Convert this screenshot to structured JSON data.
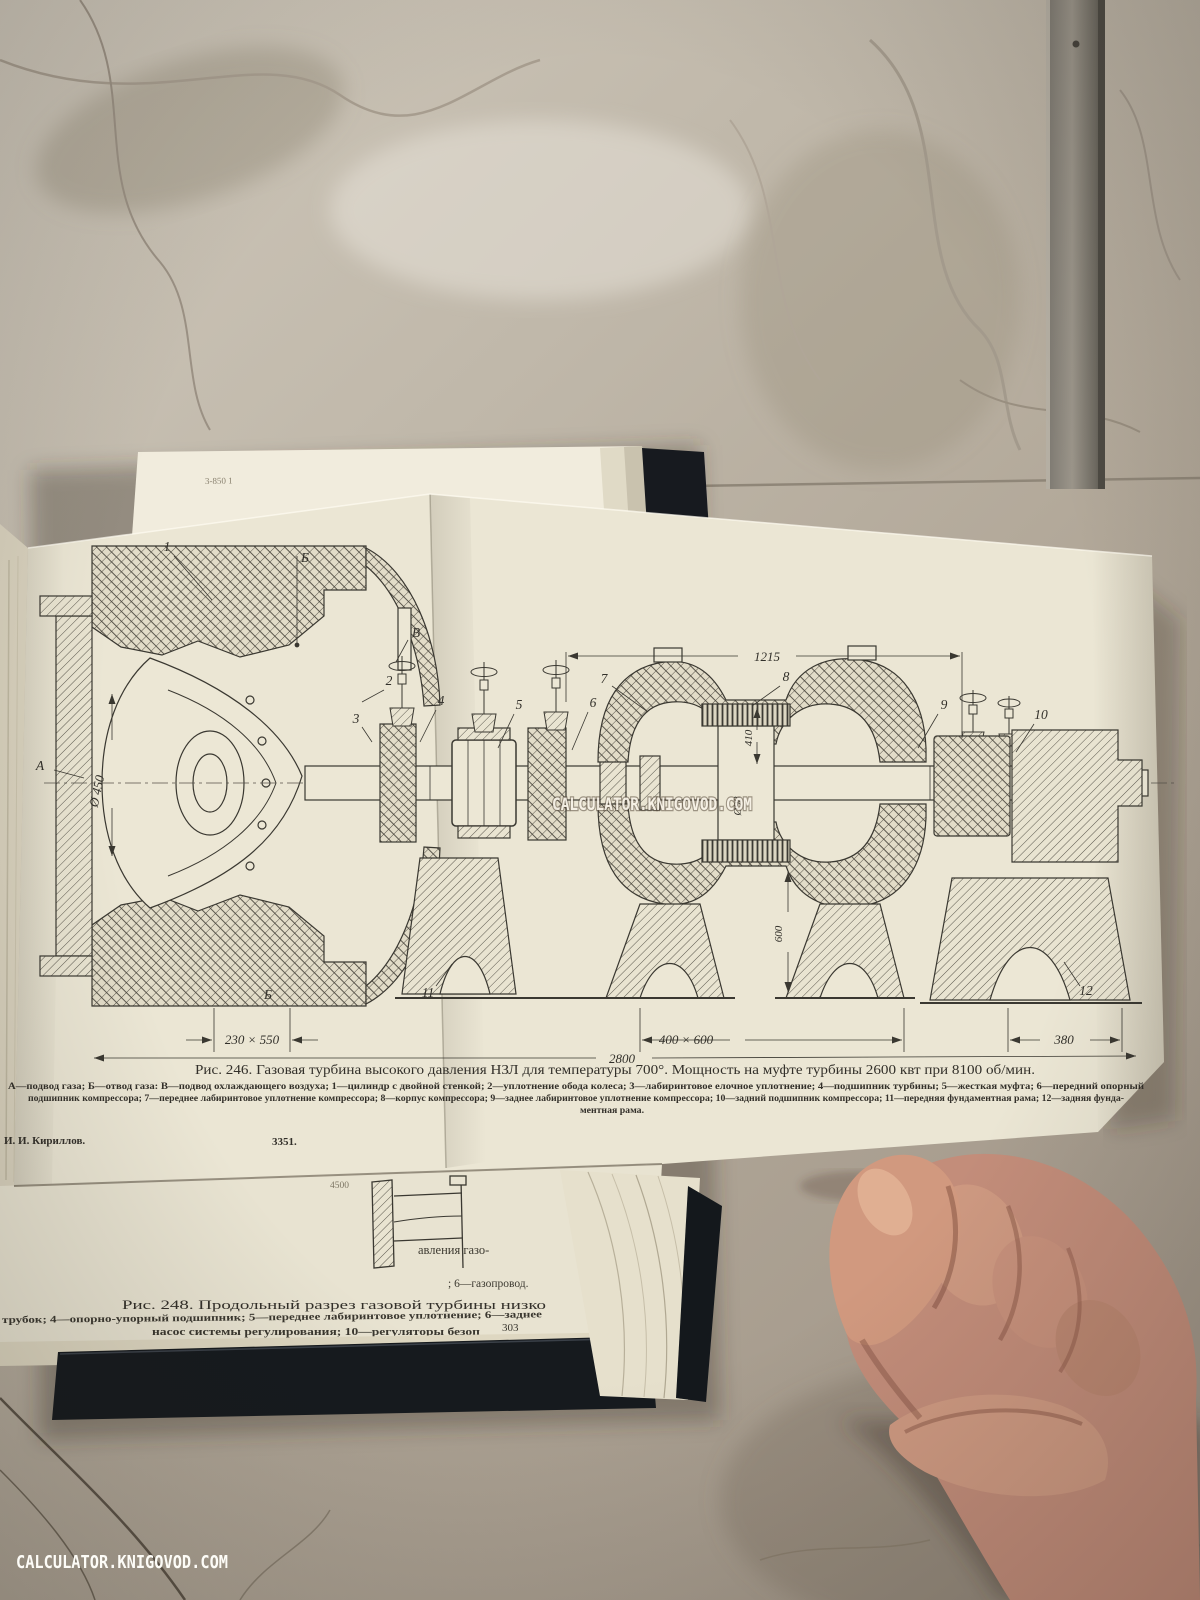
{
  "watermark": {
    "text": "CALCULATOR.KNIGOVOD.COM",
    "color": "#f7f2e7"
  },
  "foldout": {
    "edge_note": "3-850 1",
    "fig246": {
      "caption": "Рис. 246. Газовая турбина высокого давления НЗЛ для температуры 700°. Мощность на муфте турбины 2600 квт при 8100 об/мин.",
      "legend1": "А—подвод газа; Б—отвод газа: В—подвод охлаждающего воздуха; 1—цилиндр с двойной стенкой; 2—уплотнение обода колеса; 3—лабиринтовое елочное уплотнение; 4—подшипник турбины; 5—жесткая муфта; 6—передний опорный",
      "legend2": "подшипник компрессора; 7—переднее лабиринтовое уплотнение компрессора; 8—корпус компрессора; 9—заднее лабиринтовое уплотнение компрессора; 10—задний подшипник компрессора; 11—передняя фундаментная рама; 12—задняя фунда-",
      "legend3": "ментная рама.",
      "author": "И. И. Кириллов.",
      "code": "3351.",
      "dims": {
        "span_top": "1215",
        "inlet": "Ø 450",
        "h410": "410",
        "shaft": "Ø98",
        "h600": "600",
        "base_left": "230 × 550",
        "total": "2800",
        "base_mid": "400 × 600",
        "base_right": "380"
      },
      "labels": {
        "a": "А",
        "b": "Б",
        "v": "В",
        "n1": "1",
        "n2": "2",
        "n3": "3",
        "n4": "4",
        "n5": "5",
        "n6": "6",
        "n7": "7",
        "n8": "8",
        "n9": "9",
        "n10": "10",
        "n11": "11",
        "n12": "12"
      }
    }
  },
  "under_page": {
    "frag_top": "4500",
    "frag1": "авления газо-",
    "frag2": ";   6—газопровод.",
    "fig248_caption": "Рис. 248. Продольный разрез газовой турбины низко",
    "fig248_legend1": "трубок; 4—опорно-упорный подшипник; 5—переднее лабиринтовое уплотнение; 6—заднее",
    "fig248_legend2": "насос системы регулирования; 10—регуляторы безоп",
    "page_number": "303"
  }
}
